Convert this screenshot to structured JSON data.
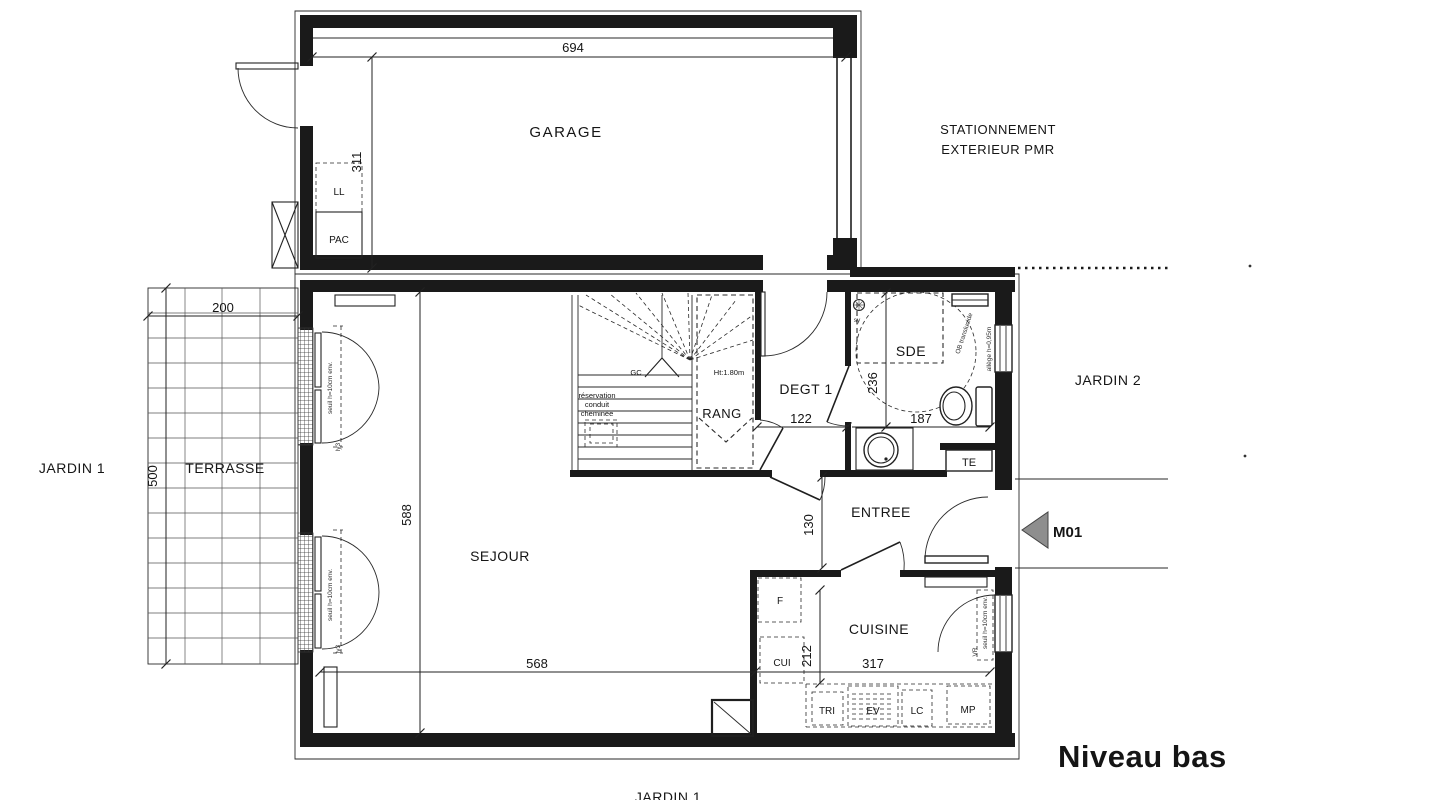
{
  "title": "Niveau bas",
  "rooms": {
    "garage": "GARAGE",
    "sejour": "SEJOUR",
    "cuisine": "CUISINE",
    "entree": "ENTREE",
    "sde": "SDE",
    "degt": "DEGT 1",
    "rang": "RANG",
    "terrasse": "TERRASSE",
    "jardin1": "JARDIN 1",
    "jardin2": "JARDIN 2",
    "stationnement1": "STATIONNEMENT",
    "stationnement2": "EXTERIEUR PMR"
  },
  "dims": {
    "garage_w": "694",
    "garage_d": "311",
    "terrasse_w": "200",
    "terrasse_d": "500",
    "sejour_d": "588",
    "sejour_w": "568",
    "cuisine_w": "317",
    "cuisine_d": "212",
    "degt_w": "122",
    "sde_w": "187",
    "sde_d": "236",
    "entree_d": "130"
  },
  "equipment": {
    "ll": "LL",
    "pac": "PAC",
    "te": "TE",
    "f": "F",
    "cui": "CUI",
    "tri": "TRI",
    "ev": "EV",
    "lc": "LC",
    "mp": "MP"
  },
  "annotations": {
    "gc": "GC",
    "sy": "sy",
    "stair_ht": "Ht:1.80m",
    "reservation1": "réservation",
    "reservation2": "conduit",
    "reservation3": "cheminée",
    "seuil": "seuil h=10cm env.",
    "ly3": "ly3",
    "ob": "OB translucide",
    "allege": "allège h=0,95m",
    "vr": "VR",
    "door_ref": "M01"
  },
  "colors": {
    "line": "#1c1c1c",
    "wall": "#1a1a1a",
    "marker_fill": "#8e8e8e"
  }
}
